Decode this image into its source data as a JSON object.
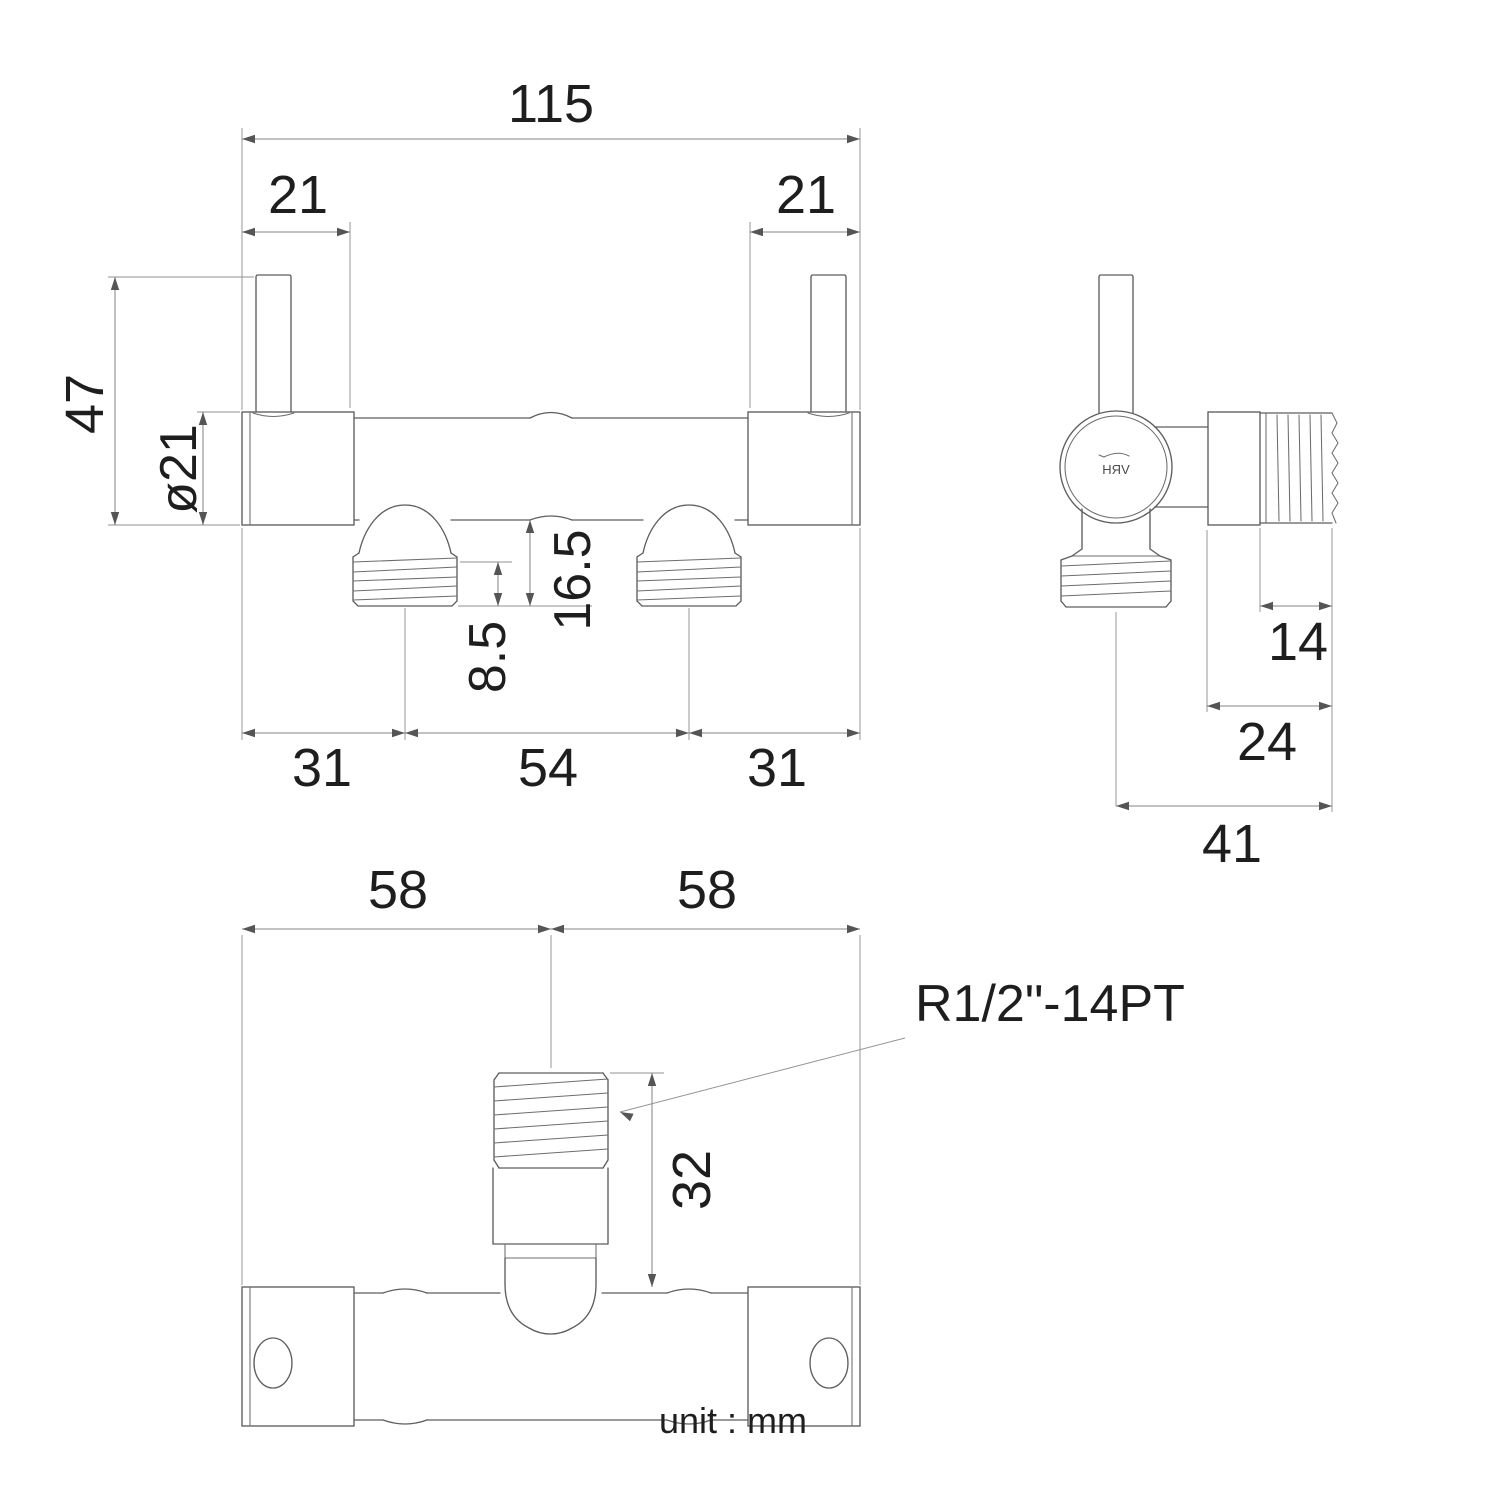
{
  "sheet": {
    "unit_note": "unit : mm",
    "brand_logo": "VRH"
  },
  "front_view": {
    "dim_total_width": "115",
    "dim_cap_left": "21",
    "dim_cap_right": "21",
    "dim_height": "47",
    "dim_body_diameter": "ø21",
    "dim_outlet_drop": "16.5",
    "dim_thread_length": "8.5",
    "dim_left_offset": "31",
    "dim_outlet_spacing": "54",
    "dim_right_offset": "31"
  },
  "side_view": {
    "dim_thread_length": "14",
    "dim_body_depth": "24",
    "dim_total_depth": "41"
  },
  "bottom_view": {
    "dim_left_half": "58",
    "dim_right_half": "58",
    "dim_inlet_height": "32",
    "thread_spec": "R1/2\"-14PT"
  }
}
